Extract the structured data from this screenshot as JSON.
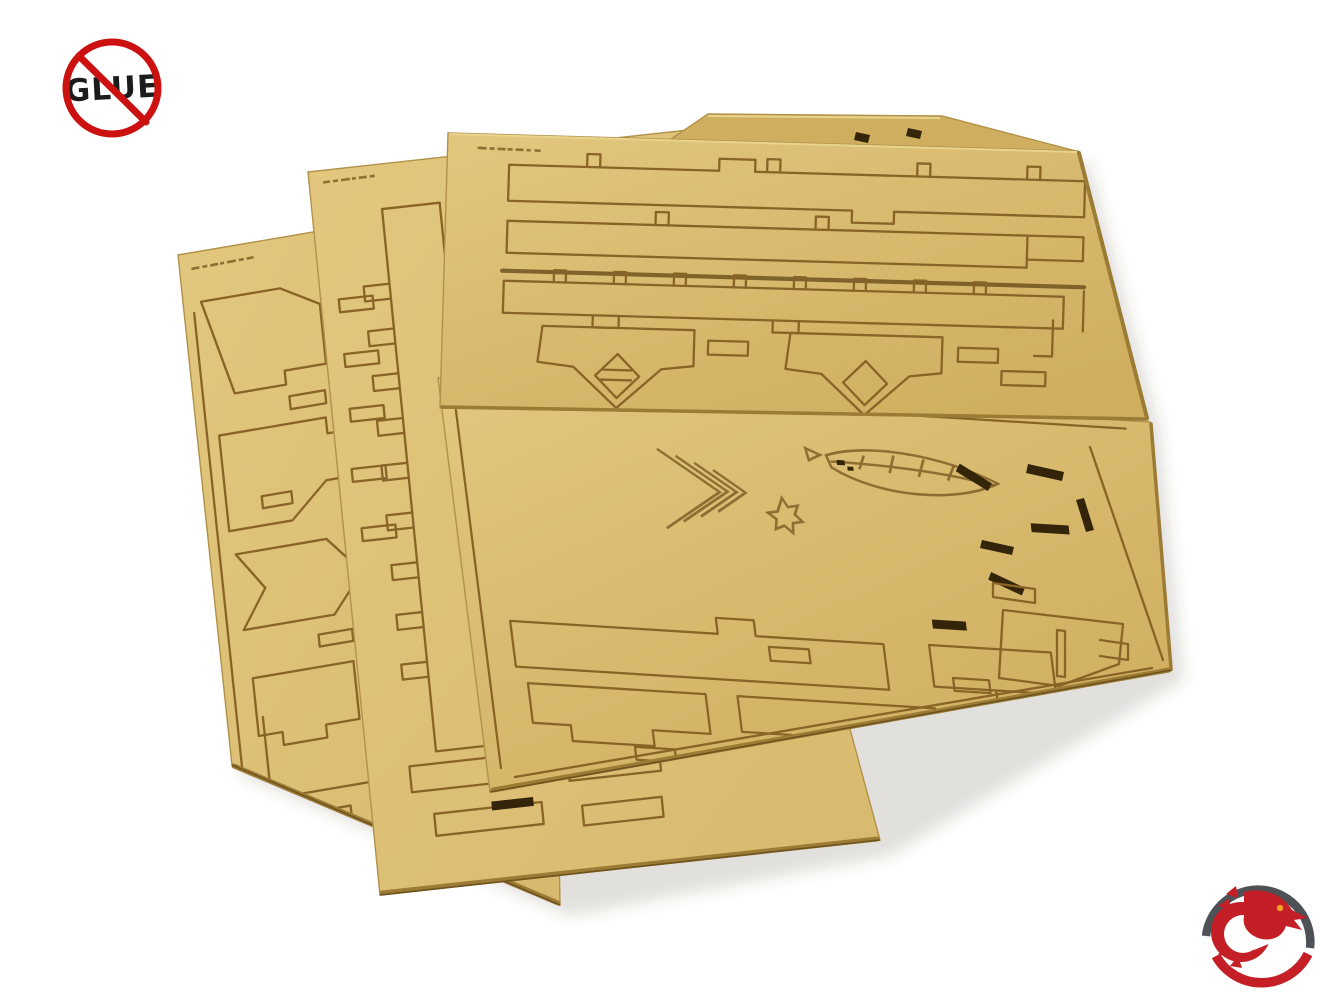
{
  "scene": {
    "type": "product-photo",
    "background": "#ffffff",
    "description": "Four fanned-out laser-cut MDF sheets of a no-glue assembly kit on a white background",
    "sheet_count": 4
  },
  "no_glue_badge": {
    "label": "GLUE",
    "ring_color": "#cc1111",
    "slash_color": "#cc1111",
    "text_color": "#1c1c1c"
  },
  "brand_logo": {
    "name": "dragon-in-ring",
    "ring_top_color": "#4e5256",
    "ring_bottom_color": "#c41e26",
    "dragon_color": "#c41e26",
    "eye_color": "#f0a028"
  },
  "materials": {
    "mdf_light": "#e2c77e",
    "mdf_base": "#d8ba6e",
    "mdf_dark": "#cfae5f",
    "mdf_edge": "#9c7c35",
    "edge_outline": "#b2914a",
    "cut_line": "#8a6326",
    "cut_heavy": "#6f531f",
    "slot_dark": "#33240a",
    "etch": "#7a5a22",
    "shadow": "rgba(80,68,34,0.16)"
  }
}
